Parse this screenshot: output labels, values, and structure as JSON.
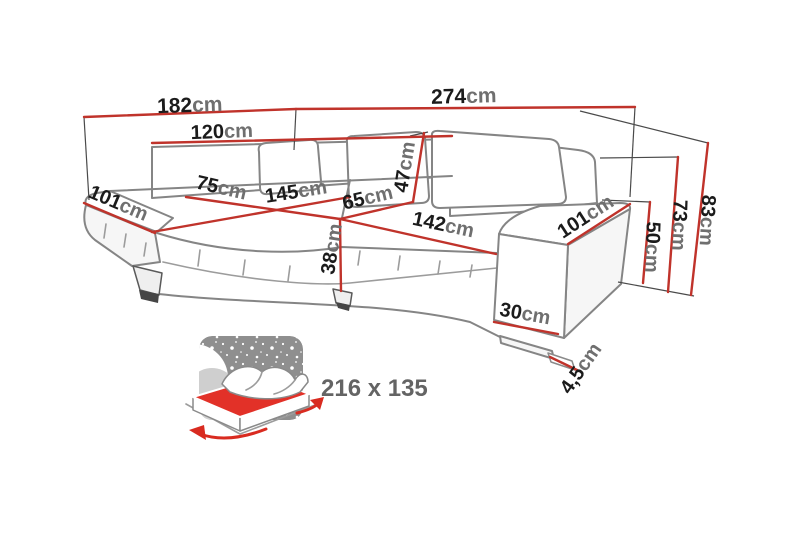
{
  "diagram": {
    "type": "corner-sofa-dimension-diagram",
    "unit": "cm"
  },
  "dimensions": {
    "d182": {
      "value": "182",
      "unit": "cm"
    },
    "d274": {
      "value": "274",
      "unit": "cm"
    },
    "d120": {
      "value": "120",
      "unit": "cm"
    },
    "d101_left": {
      "value": "101",
      "unit": "cm"
    },
    "d75": {
      "value": "75",
      "unit": "cm"
    },
    "d145": {
      "value": "145",
      "unit": "cm"
    },
    "d65": {
      "value": "65",
      "unit": "cm"
    },
    "d47": {
      "value": "47",
      "unit": "cm"
    },
    "d38": {
      "value": "38",
      "unit": "cm"
    },
    "d142": {
      "value": "142",
      "unit": "cm"
    },
    "d101_right": {
      "value": "101",
      "unit": "cm"
    },
    "d50": {
      "value": "50",
      "unit": "cm"
    },
    "d73": {
      "value": "73",
      "unit": "cm"
    },
    "d83": {
      "value": "83",
      "unit": "cm"
    },
    "d30": {
      "value": "30",
      "unit": "cm"
    },
    "d45": {
      "value": "4,5",
      "unit": "cm"
    }
  },
  "bed_inset": {
    "size_label": "216 x 135"
  },
  "colors": {
    "dimension_red": "#c0332b",
    "mattress_red": "#e23128",
    "outline_gray": "#858585",
    "label_black": "#1b1b1b",
    "unit_gray": "#6f6f6f",
    "inset_gray": "#8f8f8f",
    "inset_text_gray": "#646464"
  }
}
